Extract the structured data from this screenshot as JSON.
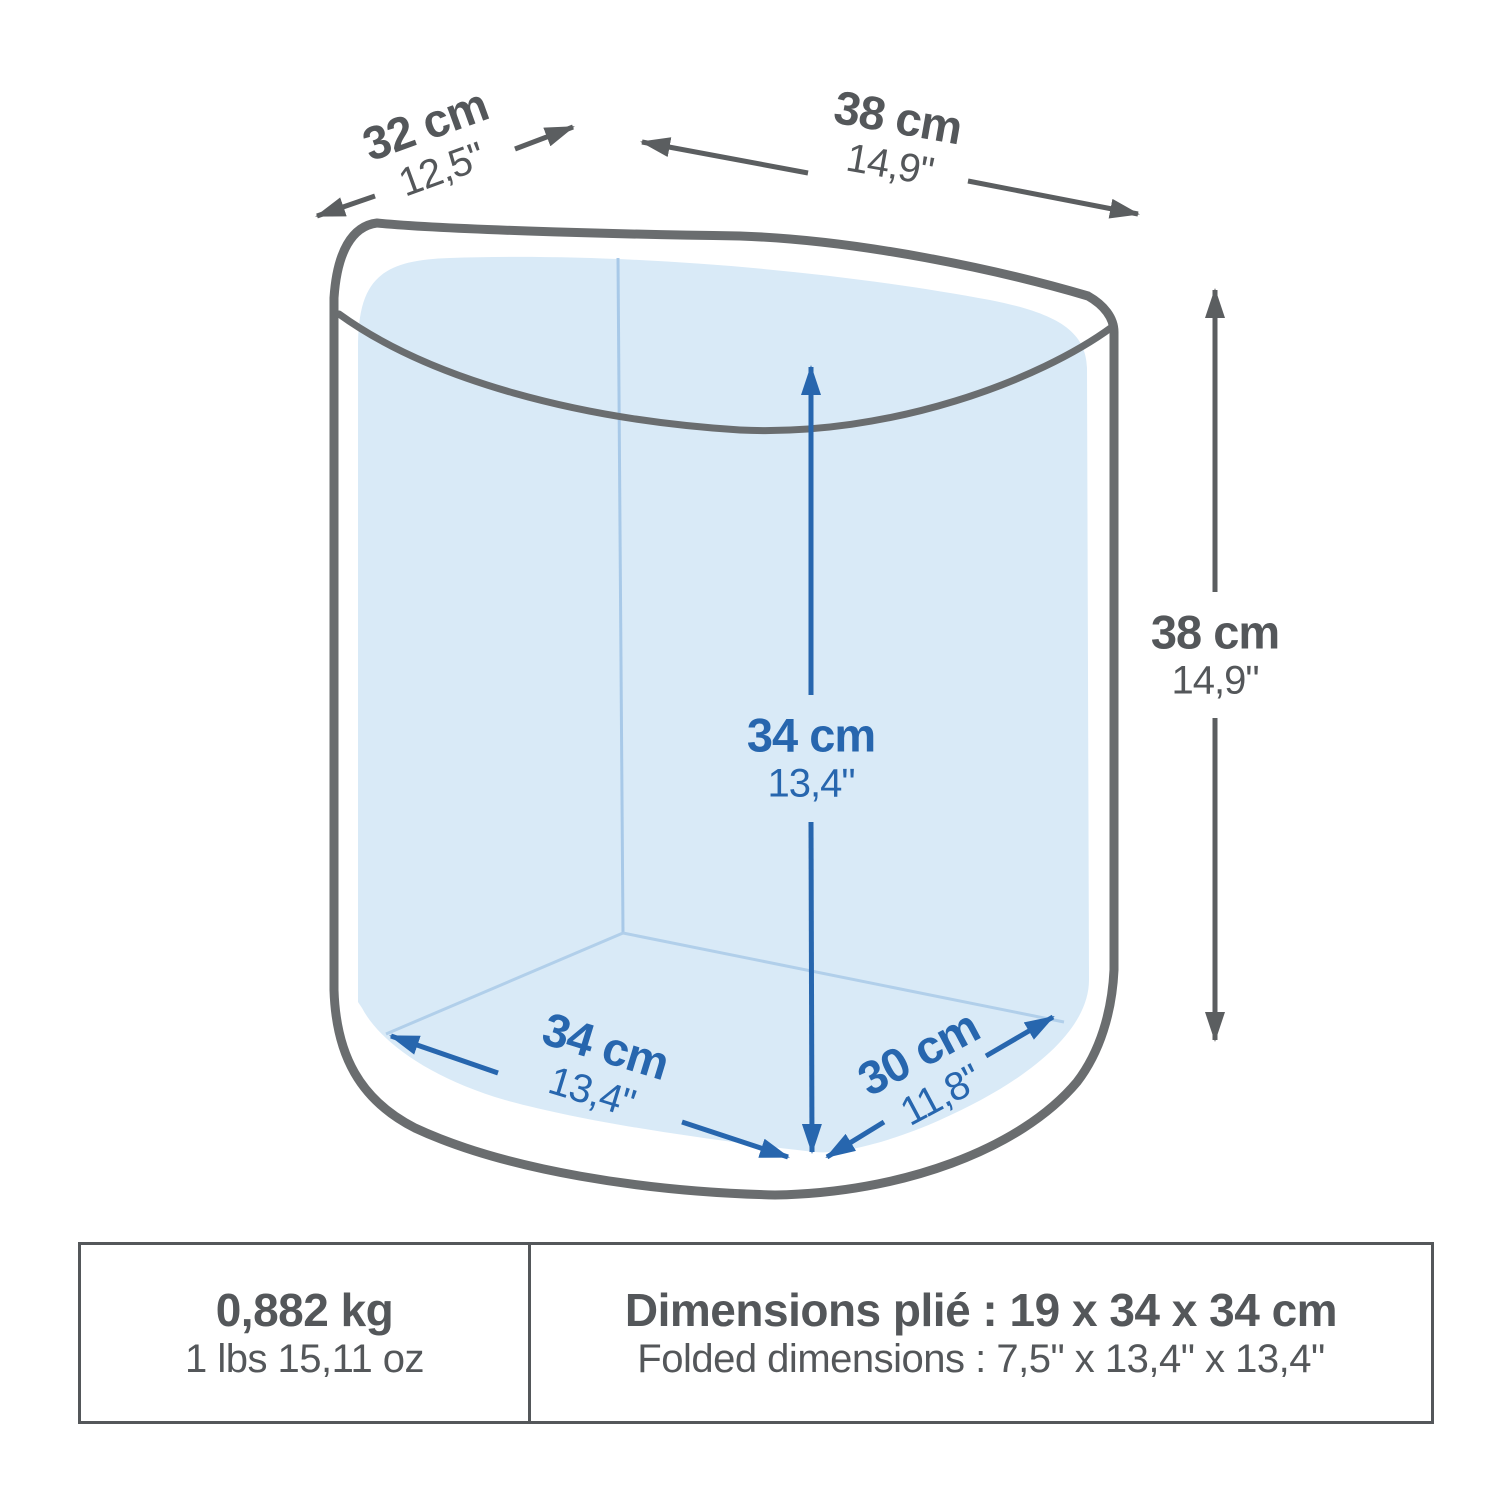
{
  "diagram": {
    "title_hint": "product-folded-container-dimensions",
    "labels": {
      "depth_top": {
        "cm": "32 cm",
        "inch": "12,5\""
      },
      "width_top": {
        "cm": "38 cm",
        "inch": "14,9\""
      },
      "height_right": {
        "cm": "38 cm",
        "inch": "14,9\""
      },
      "inner_height": {
        "cm": "34 cm",
        "inch": "13,4\""
      },
      "inner_width_floor": {
        "cm": "34 cm",
        "inch": "13,4\""
      },
      "inner_depth_floor": {
        "cm": "30 cm",
        "inch": "11,8\""
      }
    },
    "colors": {
      "outline_gray": "#6a6d6f",
      "arrow_gray": "#5b5e60",
      "text_gray": "#54575a",
      "accent_blue": "#2766ae",
      "interior_fill": "#d9eaf7",
      "faint_edge_blue": "#a8c9e8"
    }
  },
  "spec_table": {
    "weight": {
      "primary": "0,882 kg",
      "secondary": "1 lbs 15,11 oz"
    },
    "folded": {
      "primary": "Dimensions plié : 19 x 34 x 34 cm",
      "secondary": "Folded dimensions : 7,5\" x 13,4\" x 13,4\""
    }
  }
}
